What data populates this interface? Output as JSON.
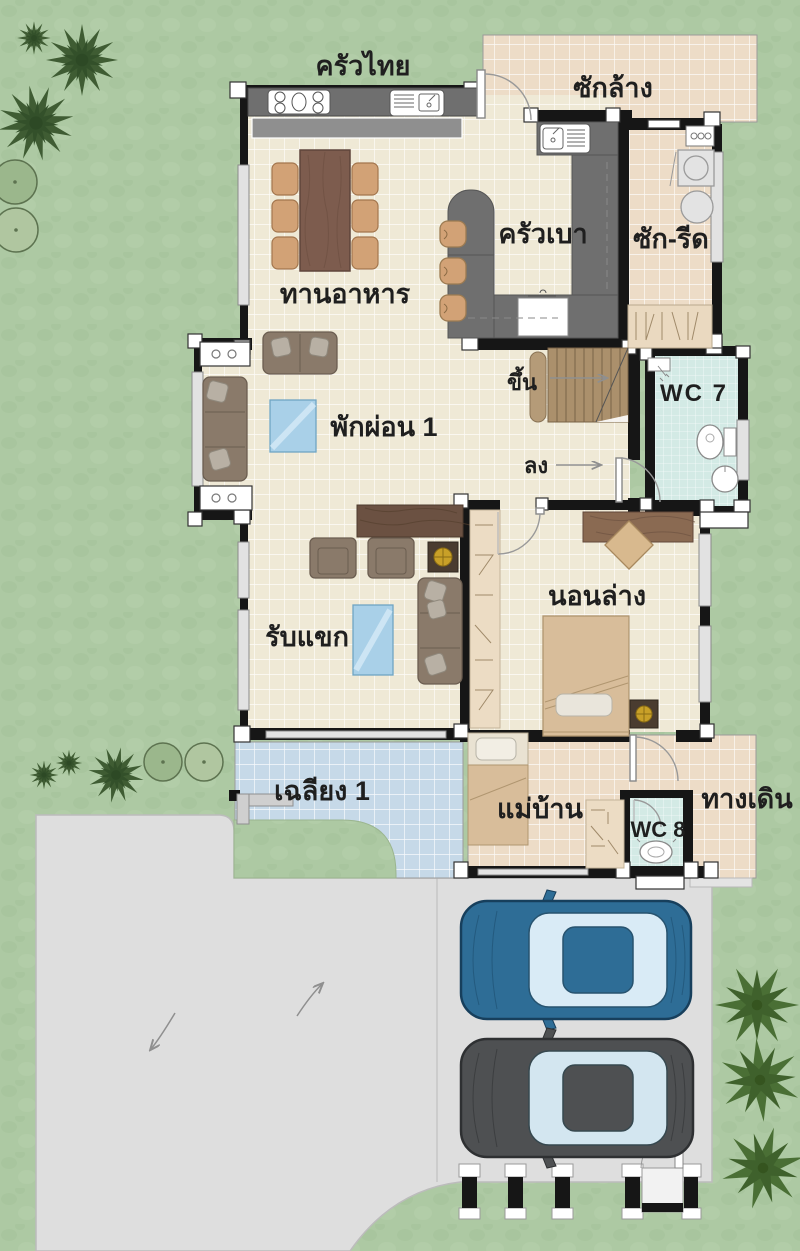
{
  "plan_type": "house-first-floor-plan",
  "rooms": {
    "thai_kitchen": "ครัวไทย",
    "wash_yard": "ซักล้าง",
    "pantry_kitchen": "ครัวเบา",
    "laundry": "ซัก-รีด",
    "dining": "ทานอาหาร",
    "stairs_up": "ขึ้น",
    "stairs_down": "ลง",
    "wc7": "WC 7",
    "lounge": "พักผ่อน 1",
    "bedroom_down": "นอนล่าง",
    "living": "รับแขก",
    "terrace": "เฉลียง 1",
    "maid": "แม่บ้าน",
    "wc8": "WC 8",
    "walkway": "ทางเดิน"
  },
  "vehicles": [
    {
      "type": "sedan-top-view",
      "color_name": "blue",
      "hex": "#2e6d96"
    },
    {
      "type": "sedan-top-view",
      "color_name": "dark-gray",
      "hex": "#4e5052"
    }
  ],
  "colors": {
    "grass": "#adc9a3",
    "tile_cream": "#efe9d6",
    "tile_tan": "#eddcc7",
    "tile_porch_blue": "#c6d9e8",
    "tile_wc": "#d3eae5",
    "wall": "#161616",
    "counter_gray": "#6f6f6f",
    "wood": "#7d5c4e",
    "driveway": "#dedede"
  }
}
